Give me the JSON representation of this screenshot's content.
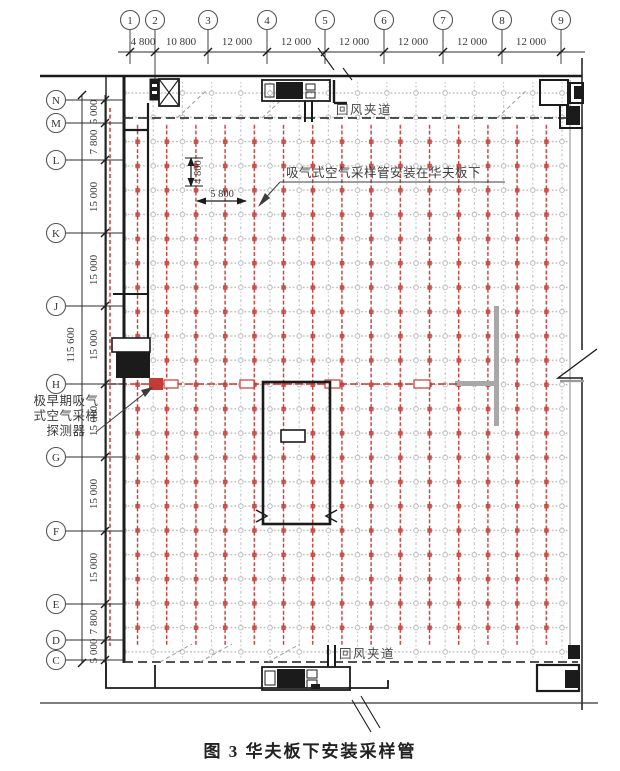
{
  "figure": {
    "caption": "图 3  华夫板下安装采样管"
  },
  "drawing": {
    "colors": {
      "pipe_red": "#c23b35",
      "grid_gray": "#b8b8b8",
      "wall_black": "#1b1b1b",
      "existing_gray": "#a8a8a8"
    },
    "top_axes": [
      "1",
      "2",
      "3",
      "4",
      "5",
      "6",
      "7",
      "8",
      "9"
    ],
    "top_dims": [
      "4 800",
      "10 800",
      "12 000",
      "12 000",
      "12 000",
      "12 000",
      "12 000",
      "12 000"
    ],
    "left_axes": [
      "N",
      "M",
      "L",
      "K",
      "J",
      "H",
      "G",
      "F",
      "E",
      "D",
      "C"
    ],
    "left_dims": [
      "5 000",
      "7 800",
      "15 000",
      "15 000",
      "15 000",
      "15 000",
      "15 000",
      "15 000",
      "7 800",
      "5 000"
    ],
    "total_dim": "115 600",
    "inner_dims": {
      "vertical": "4 800",
      "horizontal": "5 800"
    },
    "annotations": {
      "pipe_note": "吸气式空气采样管安装在华夫板下",
      "detector_note_line1": "极早期吸气",
      "detector_note_line2": "式空气采样",
      "detector_note_line3": "探测器",
      "corridor_top": "回风夹道",
      "corridor_bottom": "回风夹道"
    }
  }
}
